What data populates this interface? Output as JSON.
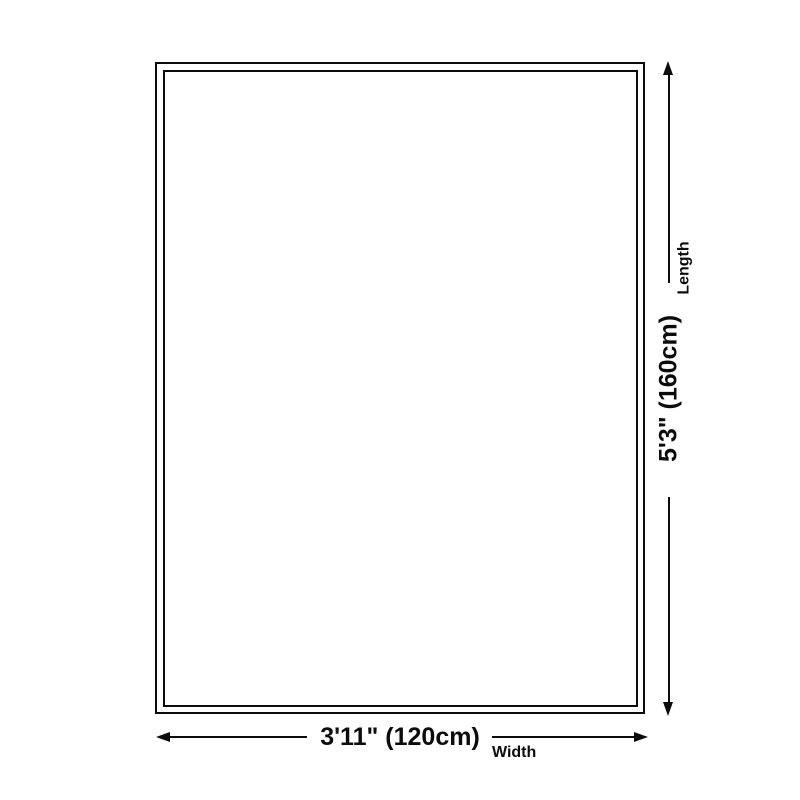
{
  "page": {
    "background": "#ffffff",
    "line_color": "#0c0c0c"
  },
  "diagram": {
    "type": "product-size-diagram",
    "length": {
      "value": "5'3\" (160cm)",
      "label": "Length"
    },
    "width": {
      "value": "3'11\" (120cm)",
      "label": "Width"
    }
  }
}
